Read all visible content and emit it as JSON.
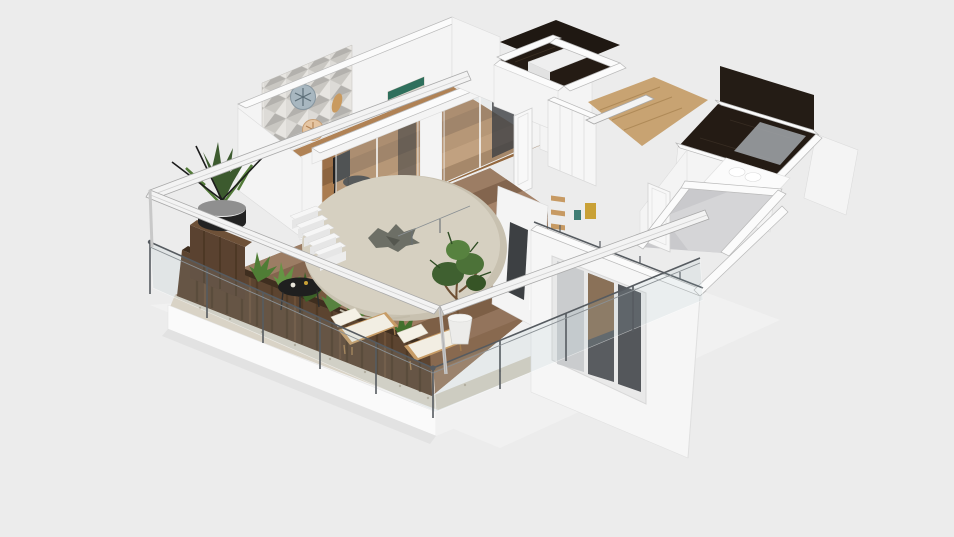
{
  "scene": {
    "type": "3d-floorplan-render",
    "viewport_label": "3D dollhouse view of apartment floor plan with roof removed",
    "render": {
      "width": 954,
      "height": 537,
      "background": "#ececec"
    },
    "palette": {
      "background": "#ececec",
      "wall_white": "#f4f4f4",
      "wall_top": "#fbfbfb",
      "wall_shadow": "#e0e0e0",
      "deck_wood": "#8f705a",
      "privacy_wood": "#5c4430",
      "interior_wood": "#b08255",
      "hall_wood": "#c8a372",
      "dark_marble": "#241b14",
      "bedroom_floor": "#c9c9cc",
      "parasol_beige": "#d6d0c1",
      "foliage_green": "#4f7d35",
      "railing_metal": "#565b60",
      "glass_tint": "rgba(165,190,198,0.14)",
      "lounger_cushion": "#f2eee3",
      "lounger_frame": "#c79c66",
      "accent_black": "#1f1f1f",
      "stone_border": "#d9d3c6",
      "shower_glass": "#a2a7ab",
      "shelf_wood": "#c79a63"
    },
    "labels": {
      "viewport": "3D floor plan viewport",
      "building": "apartment shell with cutaway walls",
      "living_dining": "living and dining room",
      "accent_wall": "geometric mosaic accent wall with round wall decor",
      "artwork": "colorful chevron artwork",
      "dining_set": "black dining table and chairs",
      "sliding_doors": "glass sliding doors to terrace",
      "hallway": "hallway with wood floor",
      "closet_room": "dark-floor closet room",
      "wardrobe": "white wardrobe with wood shelves",
      "bathroom_top": "dark marble bathroom",
      "bathroom_right": "ensuite bathroom with shower glass",
      "bedroom": "bedroom with gray floor",
      "bed": "white bed with pillows",
      "window": "triple-pane exterior window",
      "terrace": "balcony terrace with wood deck",
      "deck": "wood plank decking",
      "stone_border": "gravel stone border",
      "privacy_wall": "reclaimed wood privacy wall",
      "planter": "long green planter",
      "potted_plant": "black pot with succulents",
      "dried_twigs": "vase with dried twigs",
      "coffee_table": "round black coffee table",
      "loungers": "two sun loungers with white cushions",
      "potted_tree": "potted tree in white planter",
      "parasol": "round beige parasol table with leaf decor",
      "stairs": "white terrace steps",
      "railing": "glass railing with metal handrail",
      "pergola": "white pergola beams",
      "plinth": "white terrace base slab"
    }
  }
}
